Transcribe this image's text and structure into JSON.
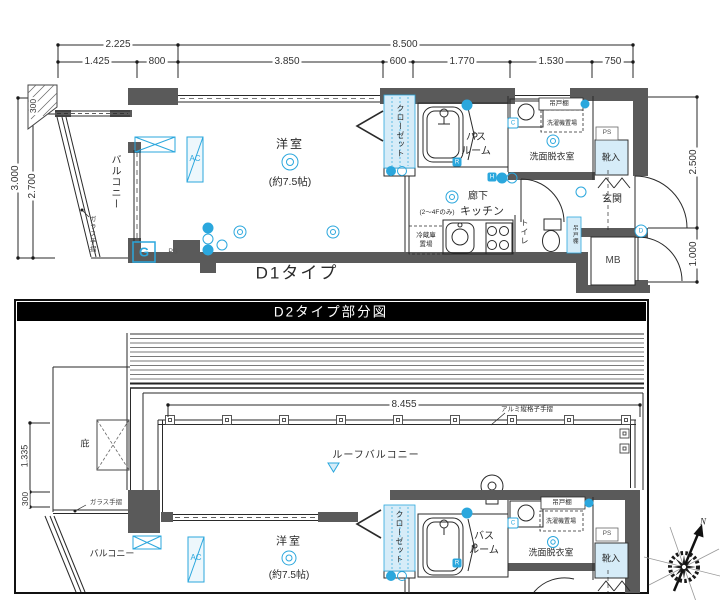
{
  "colors": {
    "wall_gray": "#5a5a5a",
    "accent_cyan": "#2ba7dd",
    "accent_cyan_fill": "#d6ecf8",
    "line_black": "#1a1a1a",
    "panel_title_bg": "#000000",
    "panel_title_fg": "#ffffff"
  },
  "d1": {
    "title": "D1タイプ",
    "dims": {
      "left_width": "2.225",
      "total_width": "8.500",
      "seg1": "1.425",
      "seg2": "800",
      "seg3": "3.850",
      "seg4": "600",
      "seg5": "1.770",
      "seg6": "1.530",
      "seg7": "750",
      "left_300": "300",
      "left_total": "3.000",
      "left_2700": "2.700",
      "right_2500": "2.500",
      "right_1000": "1.000"
    },
    "labels": {
      "balcony": "バルコニー",
      "glass_rail": "ガラス手摺",
      "ac": "AC",
      "room": "洋室",
      "room_size": "(約7.5帖)",
      "closet": "クローゼット",
      "bath_line1": "バス",
      "bath_line2": "ルーム",
      "hanging_cupboard": "吊戸棚",
      "washer_space": "洗濯機置場",
      "washroom": "洗面脱衣室",
      "ps_upper": "PS",
      "shoe_box": "靴入",
      "entrance": "玄関",
      "meter_box": "MB",
      "corridor": "廊下",
      "kitchen": "キッチン",
      "kitchen_note": "(2〜4Fのみ)",
      "fridge_line1": "冷蔵庫",
      "fridge_line2": "置場",
      "toilet": "トイレ",
      "toilet_cupboard": "吊戸棚",
      "gas_meter": "G",
      "ps_lower": "PS"
    },
    "badges": {
      "bath": "R",
      "wall": "C",
      "hall": "H",
      "entry": "D"
    }
  },
  "d2": {
    "title": "D2タイプ部分図",
    "dims": {
      "roof_width": "8.455",
      "left_1335": "1.335",
      "left_300": "300"
    },
    "labels": {
      "rail_note": "アルミ縦格子手摺",
      "roof_balcony": "ルーフバルコニー",
      "eaves": "庇",
      "glass_rail": "ガラス手摺",
      "balcony": "バルコニー",
      "ac": "AC",
      "room": "洋室",
      "room_size": "(約7.5帖)",
      "closet": "クローゼット",
      "bath_line1": "バス",
      "bath_line2": "ルーム",
      "hanging_cupboard": "吊戸棚",
      "washer_space": "洗濯機置場",
      "washroom": "洗面脱衣室",
      "ps": "PS",
      "shoe_box": "靴入"
    },
    "badges": {
      "bath": "R",
      "wall": "C"
    }
  },
  "compass": {
    "north": "N"
  }
}
